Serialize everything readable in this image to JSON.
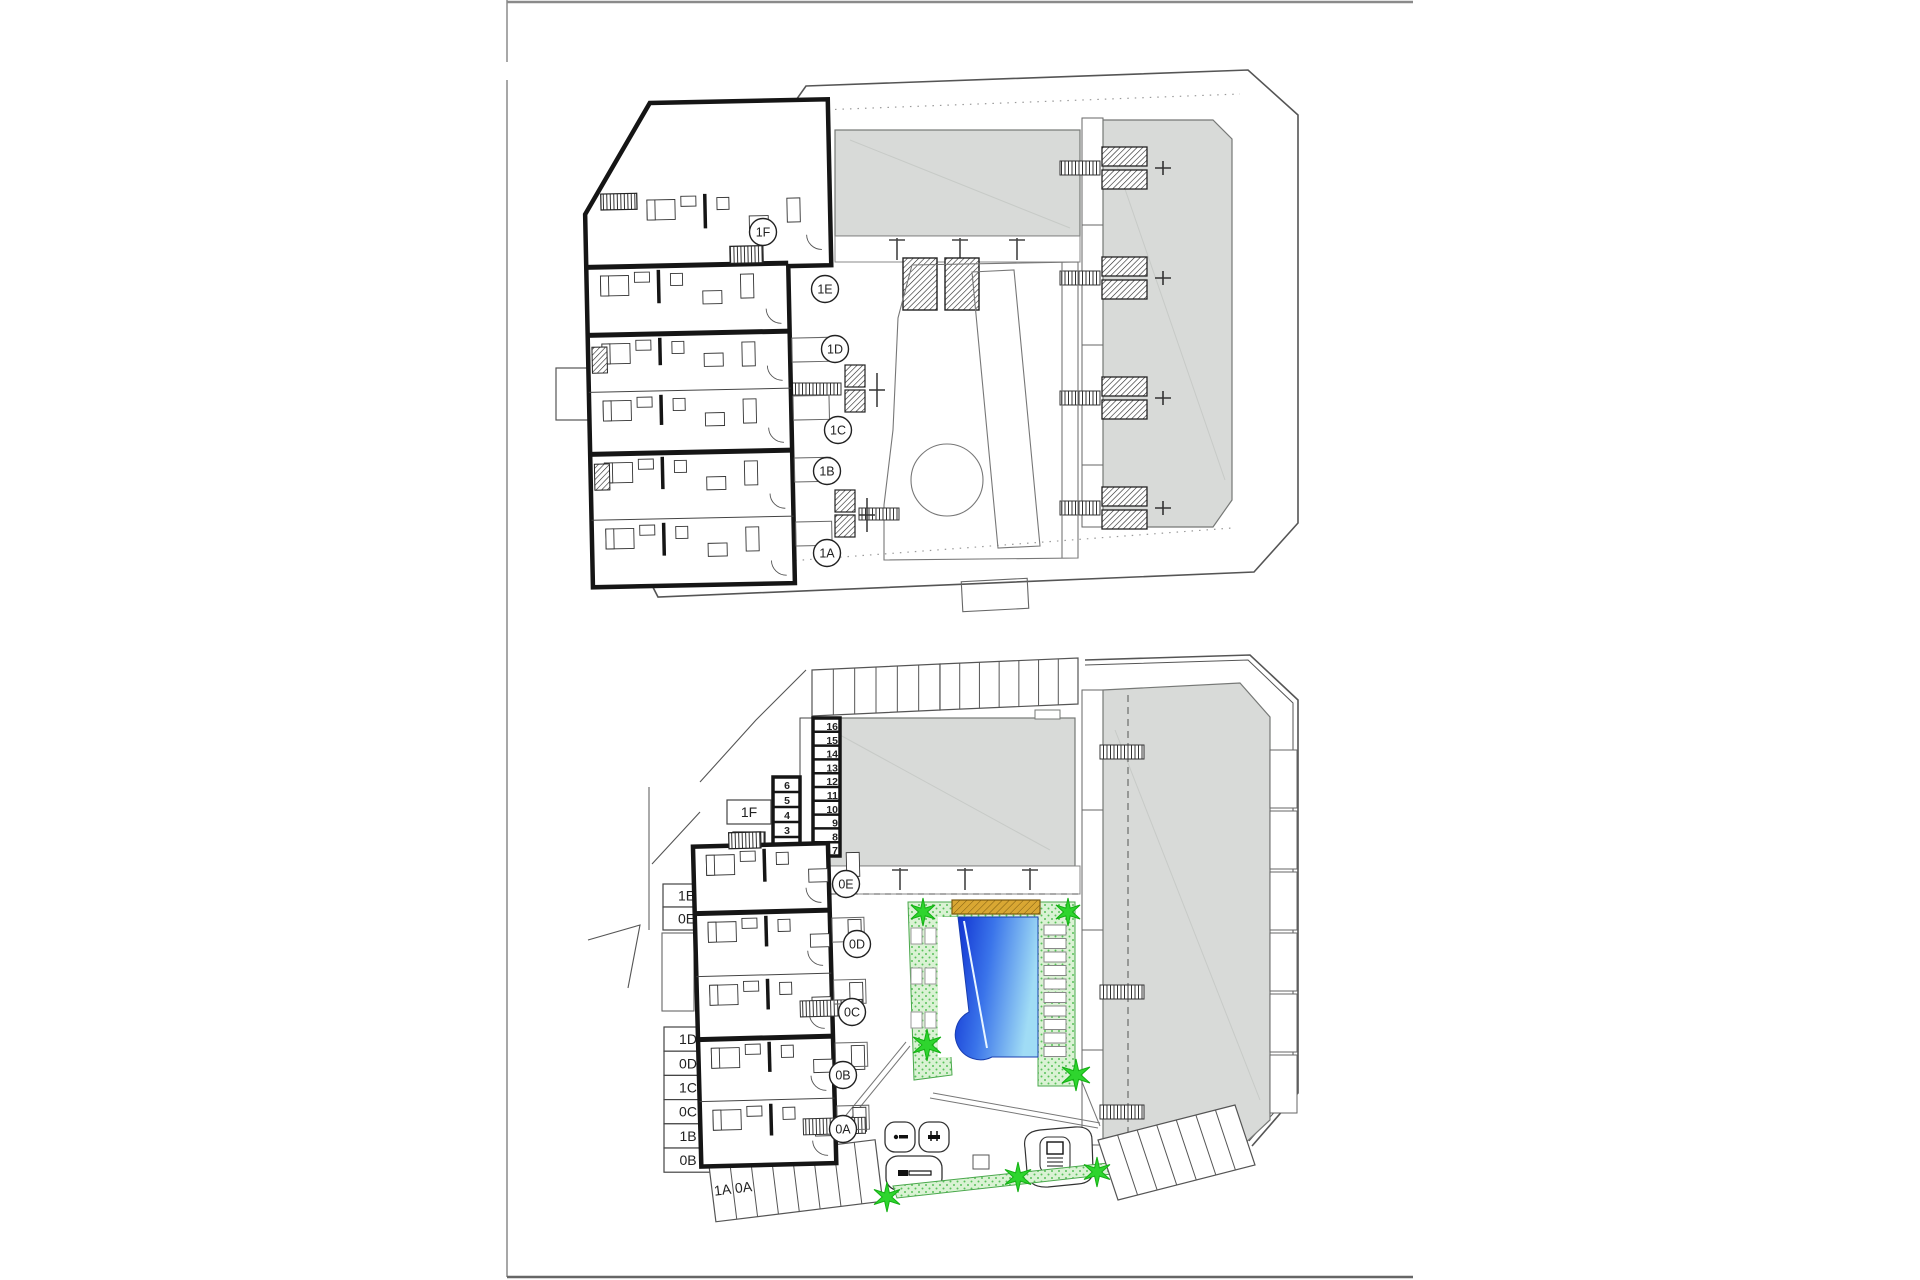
{
  "page": {
    "background": "#ffffff",
    "frame_color": "#8a8a8a"
  },
  "colors": {
    "wall": "#151515",
    "line": "#555555",
    "line_light": "#8a8a8a",
    "gray_fill": "#d8dad8",
    "gray_edge": "#767876",
    "green_light": "#daf2d4",
    "green_dot": "#58c25a",
    "star_green": "#2ed52e",
    "star_edge": "#14b014",
    "yellow_deck": "#d9a733",
    "yellow_edge": "#7a5a10",
    "pool_dark": "#0e2fd0",
    "pool_mid": "#3a74ea",
    "pool_light": "#a0dcf5"
  },
  "first_floor": {
    "unit_circles": [
      {
        "label": "1F",
        "x": 763,
        "y": 232
      },
      {
        "label": "1E",
        "x": 825,
        "y": 289
      },
      {
        "label": "1D",
        "x": 835,
        "y": 349
      },
      {
        "label": "1C",
        "x": 838,
        "y": 430
      },
      {
        "label": "1B",
        "x": 827,
        "y": 471
      },
      {
        "label": "1A",
        "x": 827,
        "y": 553
      }
    ]
  },
  "ground_floor": {
    "unit_circles": [
      {
        "label": "0E",
        "x": 846,
        "y": 884
      },
      {
        "label": "0D",
        "x": 857,
        "y": 944
      },
      {
        "label": "0C",
        "x": 852,
        "y": 1012
      },
      {
        "label": "0B",
        "x": 843,
        "y": 1075
      },
      {
        "label": "0A",
        "x": 843,
        "y": 1129
      }
    ],
    "left_labels": {
      "penthouse_box": "1F",
      "upper_pair": [
        "1E",
        "0E"
      ],
      "stack": [
        "1D",
        "0D",
        "1C",
        "0C",
        "1B",
        "0B"
      ],
      "stall_labels": [
        "1A",
        "0A"
      ]
    },
    "storage_numbers": {
      "left": [
        "6",
        "5",
        "4",
        "3",
        "2"
      ],
      "right": [
        "16",
        "15",
        "14",
        "13",
        "12",
        "11",
        "10",
        "9",
        "8",
        "7"
      ]
    },
    "parking": {
      "top_row_stalls": 13,
      "bottom_left_stalls": 8,
      "bottom_right_stalls": 7
    },
    "trees": [
      {
        "x": 923,
        "y": 912,
        "r": 14
      },
      {
        "x": 1068,
        "y": 912,
        "r": 14
      },
      {
        "x": 927,
        "y": 1045,
        "r": 16
      },
      {
        "x": 1076,
        "y": 1075,
        "r": 16
      },
      {
        "x": 887,
        "y": 1197,
        "r": 15
      },
      {
        "x": 1018,
        "y": 1177,
        "r": 15
      },
      {
        "x": 1097,
        "y": 1172,
        "r": 15
      }
    ]
  }
}
